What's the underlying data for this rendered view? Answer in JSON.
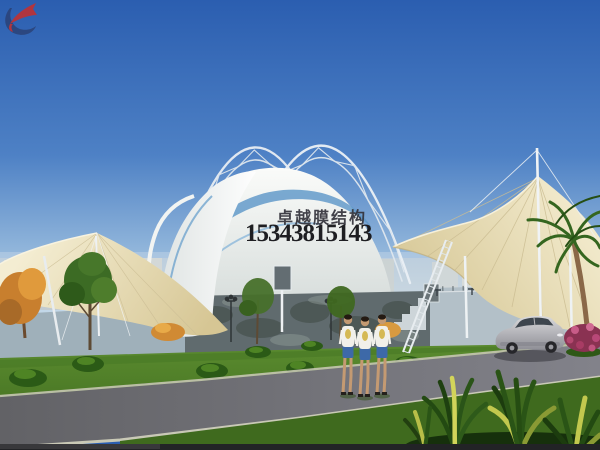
{
  "watermark": {
    "company_name": "卓越膜结构",
    "phone_number": "15343815143",
    "company_color": "#33333b",
    "phone_color": "#141418",
    "logo_colors": {
      "red": "#c23030",
      "navy": "#2a3f72"
    }
  },
  "scene": {
    "type": "architectural-rendering",
    "subject": "tensile membrane canopy structure over a sports court",
    "visible_objects": [
      "blue gradient sky",
      "crossed arched steel lattice trusses",
      "white dome membrane with blue swoosh band",
      "cream tensile fabric sails with seam lines",
      "white masts and cables",
      "gray perimeter wall with dark rock section and bleacher steps",
      "basketball backboard",
      "street lamps",
      "green lawn with shrubs",
      "autumn orange tree and green trees",
      "diagonal asphalt road with pale curbs",
      "three pedestrians walking",
      "silver sedan car",
      "palm tree",
      "pink flowering bush",
      "variegated spiky foreground plants",
      "distant city skyline"
    ],
    "palette": {
      "sky_top": "#2b5eb0",
      "sky_horizon": "#c2d7e8",
      "membrane_cream": "#e9dfb9",
      "membrane_white": "#f4f6f4",
      "accent_blue": "#5e97c8",
      "lawn": "#4c7d28",
      "road": "#6a6a6e",
      "curb": "#c8c8b4",
      "wall": "#a8b6c0",
      "car_silver": "#b9b9bd"
    }
  }
}
